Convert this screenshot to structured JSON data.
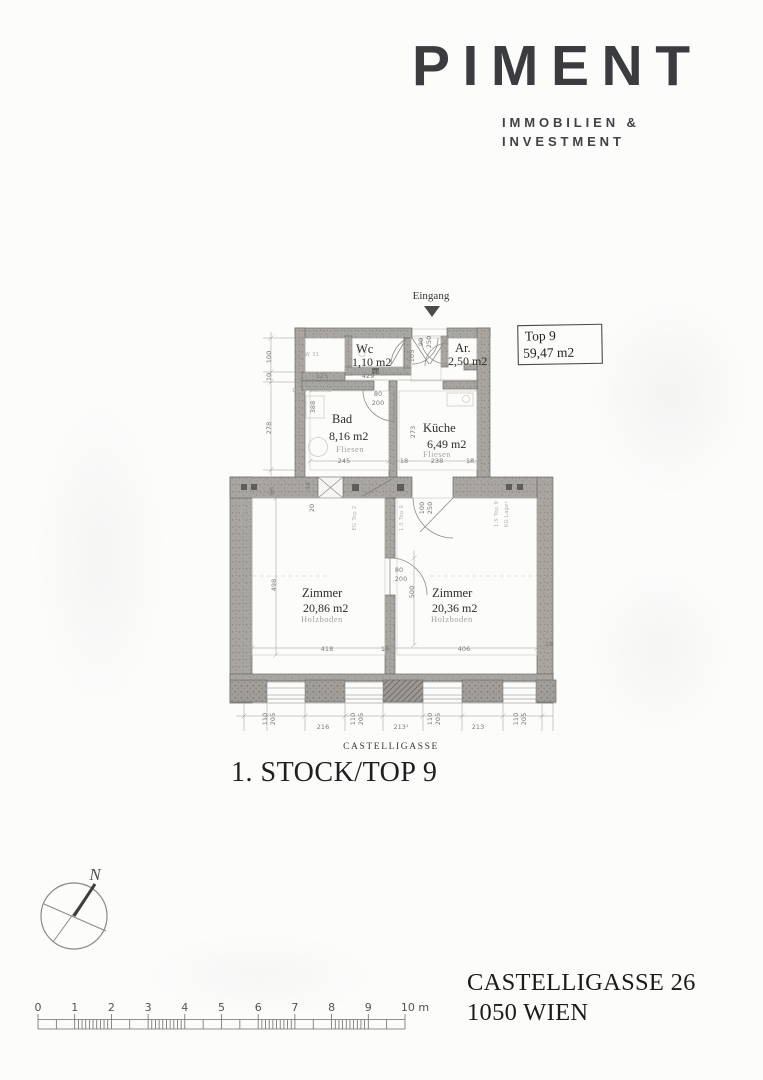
{
  "logo": {
    "name": "PIMENT",
    "tagline_line1": "IMMOBILIEN &",
    "tagline_line2": "INVESTMENT"
  },
  "plan": {
    "entrance_label": "Eingang",
    "unit_box": {
      "line1": "Top 9",
      "line2": "59,47 m2"
    },
    "street_label": "CASTELLIGASSE",
    "rooms": [
      {
        "name": "Wc",
        "area": "1,10 m2",
        "floor": "Fliesen"
      },
      {
        "name": "Ar.",
        "area": "2,50 m2",
        "floor": ""
      },
      {
        "name": "Bad",
        "area": "8,16 m2",
        "floor": "Fliesen"
      },
      {
        "name": "Küche",
        "area": "6,49 m2",
        "floor": "Fliesen"
      },
      {
        "name": "Zimmer",
        "area": "20,86 m2",
        "floor": "Holzboden"
      },
      {
        "name": "Zimmer",
        "area": "20,36 m2",
        "floor": "Holzboden"
      }
    ],
    "dim_labels": [
      {
        "t": "100",
        "x": 271,
        "y": 357,
        "r": -90
      },
      {
        "t": "10",
        "x": 271,
        "y": 377,
        "r": -90
      },
      {
        "t": "278",
        "x": 271,
        "y": 428,
        "r": -90
      },
      {
        "t": "86",
        "x": 274,
        "y": 491,
        "r": -90
      },
      {
        "t": "498",
        "x": 276,
        "y": 585,
        "r": -90
      },
      {
        "t": "388",
        "x": 315,
        "y": 407,
        "r": -90
      },
      {
        "t": "44",
        "x": 310,
        "y": 486,
        "r": -90
      },
      {
        "t": "20",
        "x": 314,
        "y": 508,
        "r": -90
      },
      {
        "t": "125",
        "x": 322,
        "y": 378
      },
      {
        "t": "429",
        "x": 368,
        "y": 378
      },
      {
        "t": "105",
        "x": 414,
        "y": 356,
        "r": -90
      },
      {
        "t": "90",
        "x": 423,
        "y": 342,
        "r": -90
      },
      {
        "t": "250",
        "x": 431,
        "y": 342,
        "r": -90
      },
      {
        "t": "80",
        "x": 378,
        "y": 396
      },
      {
        "t": "200",
        "x": 378,
        "y": 405
      },
      {
        "t": "273",
        "x": 415,
        "y": 432,
        "r": -90
      },
      {
        "t": "245",
        "x": 344,
        "y": 463
      },
      {
        "t": "18",
        "x": 404,
        "y": 463
      },
      {
        "t": "238",
        "x": 437,
        "y": 463
      },
      {
        "t": "18",
        "x": 470,
        "y": 463
      },
      {
        "t": "100",
        "x": 424,
        "y": 508,
        "r": -90
      },
      {
        "t": "250",
        "x": 432,
        "y": 508,
        "r": -90
      },
      {
        "t": "80",
        "x": 399,
        "y": 572
      },
      {
        "t": "200",
        "x": 401,
        "y": 581
      },
      {
        "t": "500",
        "x": 414,
        "y": 592,
        "r": -90
      },
      {
        "t": "418",
        "x": 327,
        "y": 651
      },
      {
        "t": "18",
        "x": 385,
        "y": 651
      },
      {
        "t": "406",
        "x": 464,
        "y": 651
      },
      {
        "t": "18",
        "x": 549,
        "y": 646
      },
      {
        "t": "110",
        "x": 267,
        "y": 719,
        "r": -90
      },
      {
        "t": "205",
        "x": 275,
        "y": 719,
        "r": -90
      },
      {
        "t": "216",
        "x": 323,
        "y": 729
      },
      {
        "t": "110",
        "x": 355,
        "y": 719,
        "r": -90
      },
      {
        "t": "205",
        "x": 363,
        "y": 719,
        "r": -90
      },
      {
        "t": "213¹",
        "x": 401,
        "y": 729
      },
      {
        "t": "110",
        "x": 432,
        "y": 719,
        "r": -90
      },
      {
        "t": "205",
        "x": 440,
        "y": 719,
        "r": -90
      },
      {
        "t": "213",
        "x": 478,
        "y": 729
      },
      {
        "t": "110",
        "x": 518,
        "y": 719,
        "r": -90
      },
      {
        "t": "205",
        "x": 526,
        "y": 719,
        "r": -90
      }
    ],
    "wall_annotations": [
      {
        "t": "IW 31",
        "x": 311,
        "y": 356,
        "r": 0
      },
      {
        "t": "1.O 5 Lichthof",
        "x": 312,
        "y": 392,
        "r": 0
      },
      {
        "t": "EG Top 4",
        "x": 244,
        "y": 512,
        "r": -90
      },
      {
        "t": "1.S Top 8",
        "x": 252,
        "y": 512,
        "r": -90
      },
      {
        "t": "EG Top 2",
        "x": 356,
        "y": 518,
        "r": -90
      },
      {
        "t": "1.S Top 9",
        "x": 403,
        "y": 518,
        "r": -90
      },
      {
        "t": "1.S Top 9",
        "x": 498,
        "y": 514,
        "r": -90
      },
      {
        "t": "KG Lager",
        "x": 508,
        "y": 514,
        "r": -90
      }
    ]
  },
  "title": "1. STOCK/TOP 9",
  "compass": {
    "north_label": "N"
  },
  "scalebar": {
    "tick_labels": [
      "0",
      "1",
      "2",
      "3",
      "4",
      "5",
      "6",
      "7",
      "8",
      "9",
      "10 m"
    ],
    "unit": "m"
  },
  "address": {
    "line1": "CASTELLIGASSE 26",
    "line2": "1050 WIEN"
  },
  "colors": {
    "wall_gray": "#a9a6a1",
    "line_gray": "#8a8a8a",
    "dim_gray": "#7d7b78",
    "text_dark": "#2f2d2b",
    "logo_color": "#3a3c3f"
  }
}
